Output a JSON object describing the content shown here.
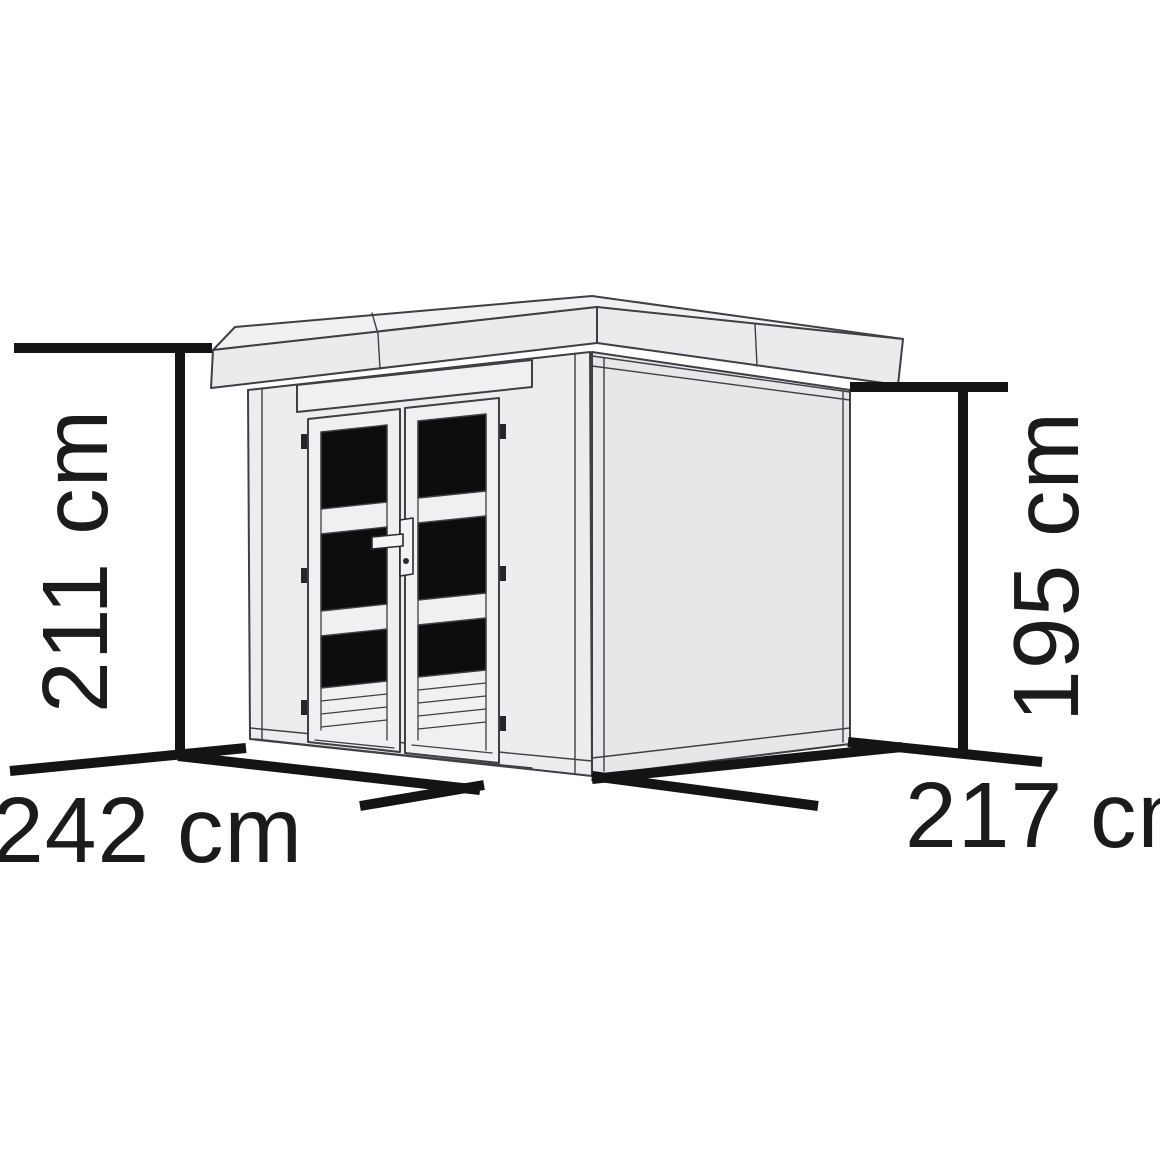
{
  "labels": {
    "height_total": "211 cm",
    "wall_height": "195 cm",
    "width": "242 cm",
    "depth": "217 cm"
  },
  "colors": {
    "dimension_line": "#141414",
    "label_text": "#1b1b1b",
    "outline": "#3f3f44",
    "wall_fill": "#ececee",
    "side_wall_fill": "#e7e7ea",
    "roof_fill": "#f1f1f3",
    "window_pane_fill": "#0d0d0e",
    "background": "#ffffff"
  }
}
